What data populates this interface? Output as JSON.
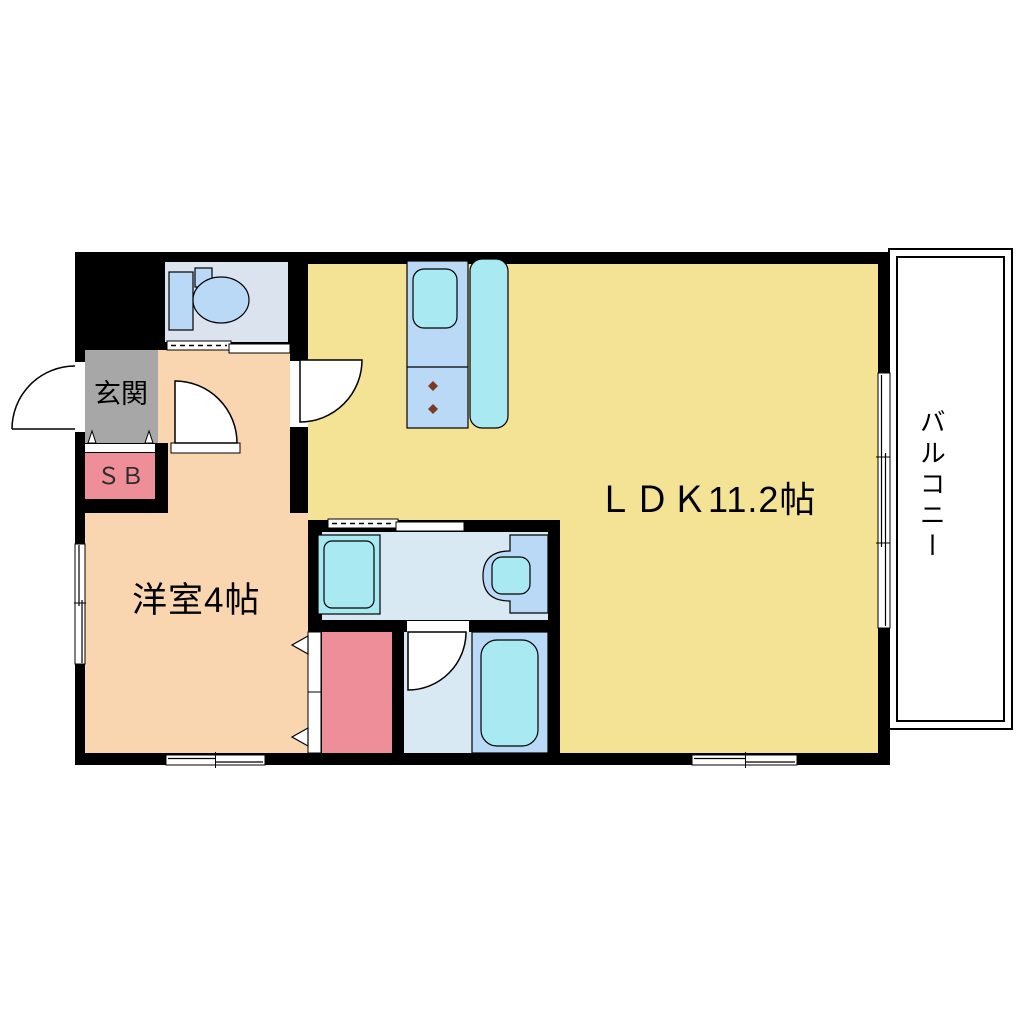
{
  "diagram_type": "apartment-floor-plan",
  "rooms": {
    "ldk": {
      "label": "ＬＤＫ11.2帖",
      "floor_color": "#F5E395"
    },
    "western_room": {
      "label": "洋室4帖",
      "floor_color": "#FAD6B0"
    },
    "entrance": {
      "label": "玄関",
      "floor_color": "#A7A7A7"
    },
    "shoe_box": {
      "label": "ＳＢ",
      "floor_color": "#EE8E99"
    },
    "balcony": {
      "label": "バルコニー",
      "floor_color": "#FFFFFF"
    },
    "toilet": {
      "floor_color": "#DBE3EF"
    },
    "washroom": {
      "floor_color": "#D9E9F3"
    },
    "bathroom": {
      "floor_color": "#D9E9F3"
    },
    "closet": {
      "floor_color": "#EE8E99"
    }
  },
  "fixture_icons": [
    "toilet-icon",
    "kitchen-counter-sink-icon",
    "stove-burner-icon",
    "refrigerator-icon",
    "washing-machine-icon",
    "wash-basin-icon",
    "bathtub-icon"
  ],
  "colors": {
    "wall": "#000000",
    "fixture_blue": "#B9D9F7",
    "fixture_cyan": "#A9EAF2",
    "burner_brown": "#7A3B20",
    "background": "#FFFFFF"
  }
}
